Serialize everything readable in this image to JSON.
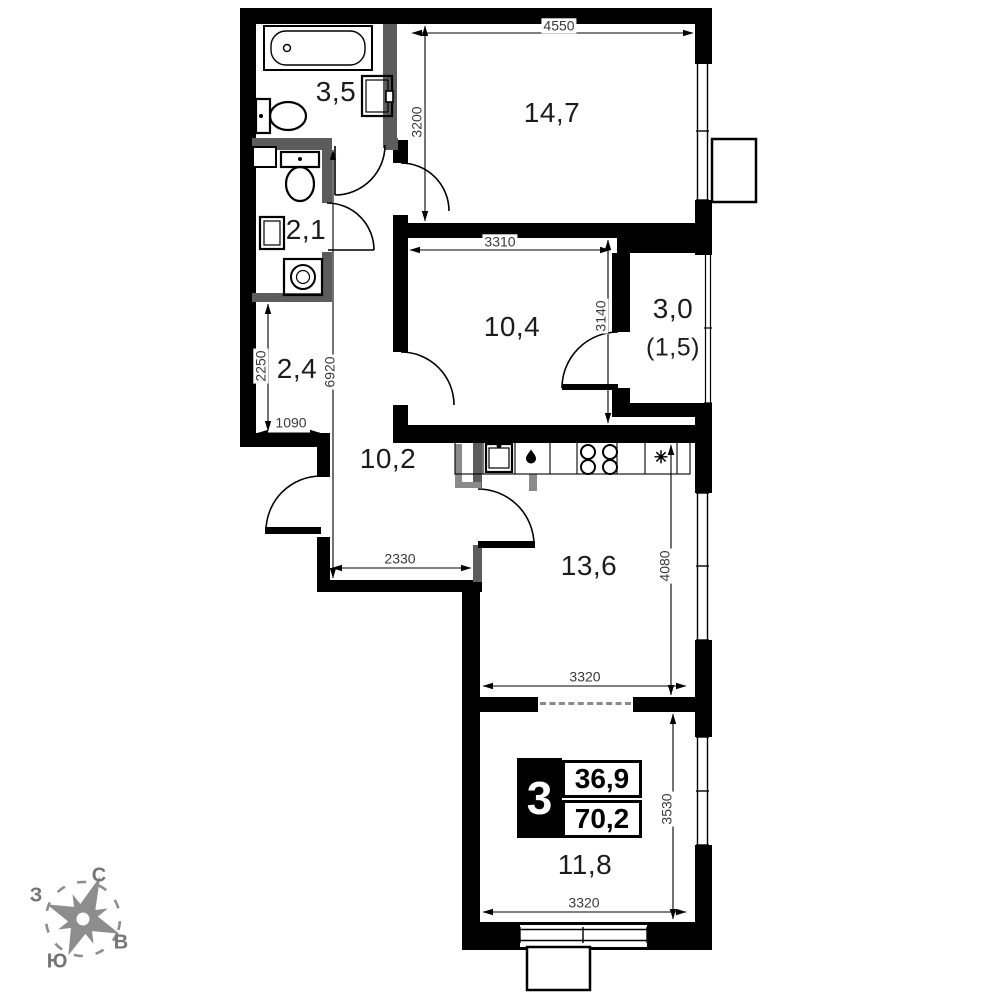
{
  "plan": {
    "rooms": [
      {
        "id": "bathroom",
        "area": "3,5"
      },
      {
        "id": "wc",
        "area": "2,1"
      },
      {
        "id": "hall-small",
        "area": "2,4"
      },
      {
        "id": "living-room",
        "area": "14,7"
      },
      {
        "id": "bedroom",
        "area": "10,4"
      },
      {
        "id": "balcony",
        "area": "3,0",
        "area_reduced": "(1,5)"
      },
      {
        "id": "corridor",
        "area": "10,2"
      },
      {
        "id": "kitchen",
        "area": "13,6"
      },
      {
        "id": "lower-room",
        "area": "11,8"
      }
    ],
    "dimensions": {
      "d4550": "4550",
      "d3200": "3200",
      "d3310": "3310",
      "d3140": "3140",
      "d2250": "2250",
      "d1090": "1090",
      "d6920": "6920",
      "d2330": "2330",
      "d4080": "4080",
      "d3320_kitchen": "3320",
      "d3530": "3530",
      "d3320_room": "3320"
    },
    "info": {
      "rooms_count": "3",
      "living_area": "36,9",
      "total_area": "70,2"
    },
    "compass": {
      "north": "С",
      "south": "Ю",
      "west": "З",
      "east": "В"
    },
    "kitchen_star": "✳",
    "colors": {
      "wall": "#000000",
      "partition": "#5c5c5c",
      "dim_text": "#3a3a3a",
      "compass": "#8d8d8d"
    }
  }
}
